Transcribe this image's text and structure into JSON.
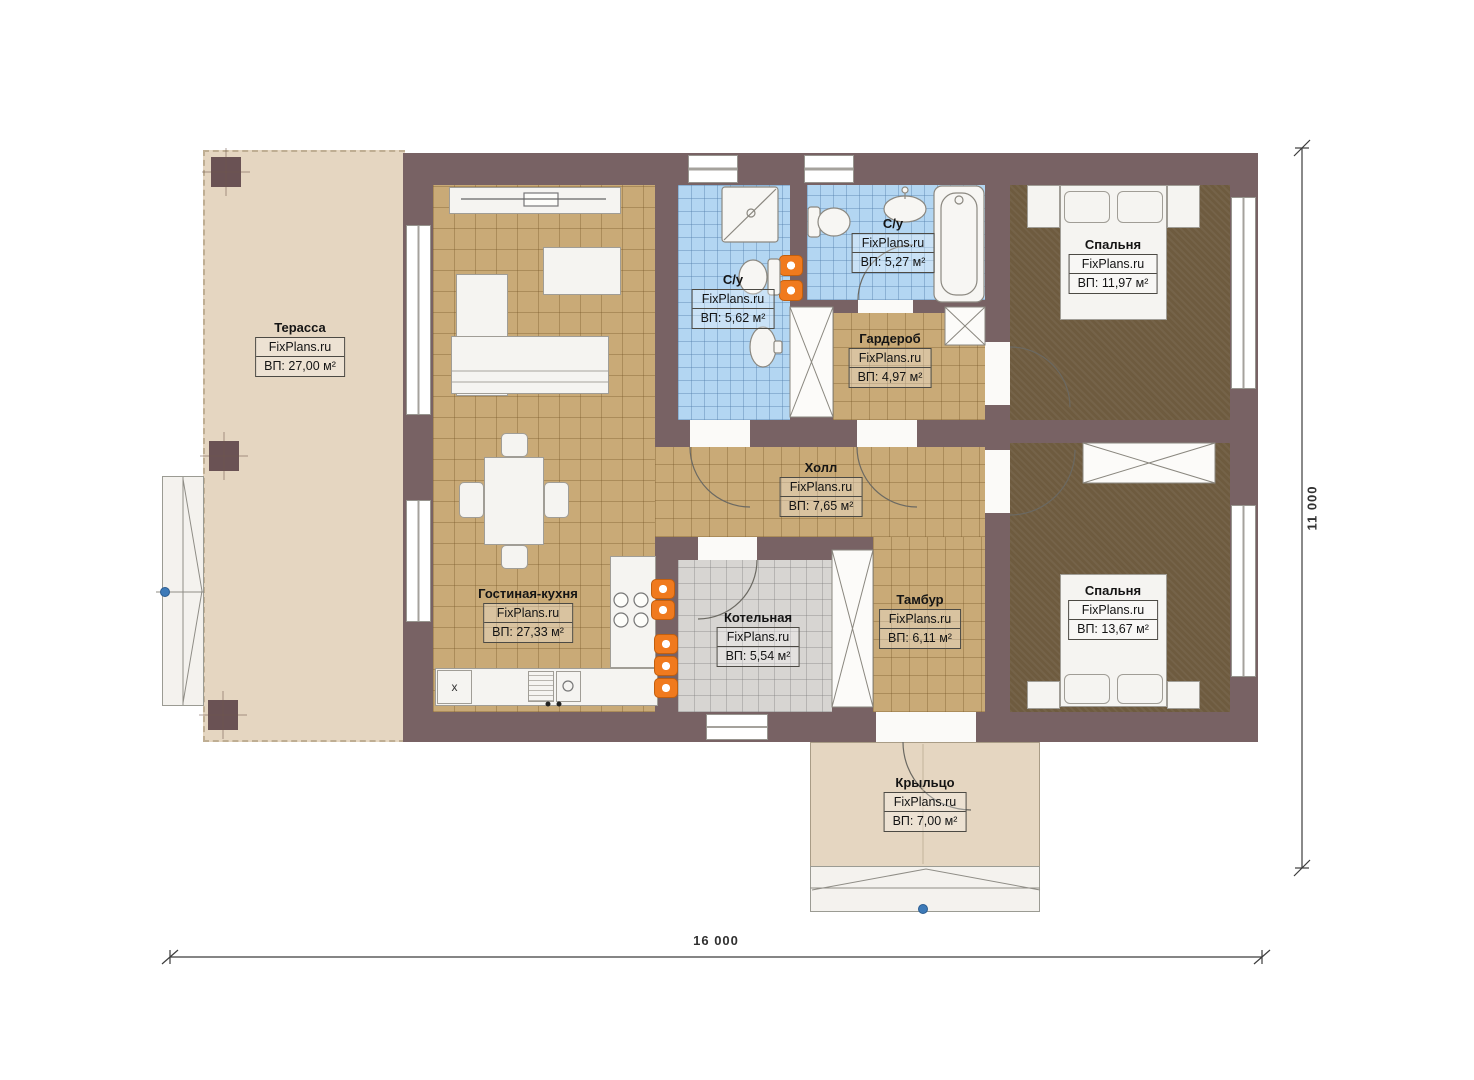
{
  "brand": "FixPlans.ru",
  "rooms": [
    {
      "name": "Терасса",
      "brand": "FixPlans.ru",
      "area": "ВП: 27,00 м²"
    },
    {
      "name": "Гостиная-кухня",
      "brand": "FixPlans.ru",
      "area": "ВП: 27,33 м²"
    },
    {
      "name": "С/у",
      "brand": "FixPlans.ru",
      "area": "ВП: 5,62 м²"
    },
    {
      "name": "С/у",
      "brand": "FixPlans.ru",
      "area": "ВП: 5,27 м²"
    },
    {
      "name": "Спальня",
      "brand": "FixPlans.ru",
      "area": "ВП: 11,97 м²"
    },
    {
      "name": "Гардероб",
      "brand": "FixPlans.ru",
      "area": "ВП: 4,97 м²"
    },
    {
      "name": "Холл",
      "brand": "FixPlans.ru",
      "area": "ВП: 7,65 м²"
    },
    {
      "name": "Котельная",
      "brand": "FixPlans.ru",
      "area": "ВП: 5,54 м²"
    },
    {
      "name": "Тамбур",
      "brand": "FixPlans.ru",
      "area": "ВП: 6,11 м²"
    },
    {
      "name": "Спальня",
      "brand": "FixPlans.ru",
      "area": "ВП: 13,67 м²"
    },
    {
      "name": "Крыльцо",
      "brand": "FixPlans.ru",
      "area": "ВП: 7,00 м²"
    }
  ],
  "dimensions": {
    "width": "16 000",
    "height": "11 000"
  },
  "markers": {
    "kitchen_cabinet": "x"
  },
  "colors": {
    "wall": "#786264",
    "floor_tan": "#c9aa77",
    "floor_blue": "#b3d6f2",
    "floor_gray": "#d7d5d2",
    "carpet": "#6e5b3f",
    "terrace": "#e5d6c1",
    "radiator": "#f07a1e",
    "marker_dot": "#3d7ab8"
  }
}
